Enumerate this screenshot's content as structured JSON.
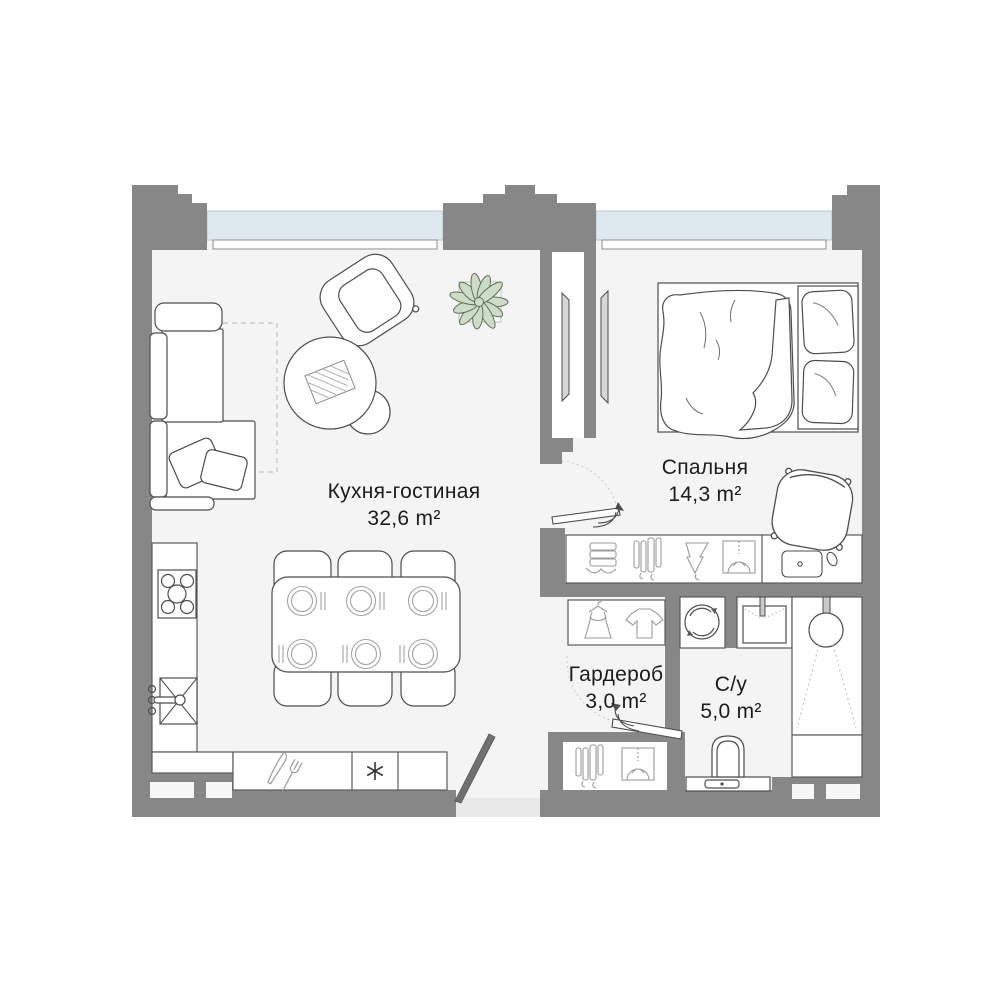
{
  "plan": {
    "rooms": [
      {
        "name": "Кухня-гостиная",
        "area": "32,6 m²"
      },
      {
        "name": "Спальня",
        "area": "14,3 m²"
      },
      {
        "name": "Гардероб",
        "area": "3,0 m²"
      },
      {
        "name": "С/у",
        "area": "5,0 m²"
      }
    ],
    "icons": {
      "freezer-asterisk-icon": "✳",
      "hob-icon": "4+1 burner circles",
      "kitchen-sink-icon": "crossed square with faucet",
      "cutlery-icon": "knife and fork",
      "washing-machine-icon": "circle with rotation arrows",
      "bathroom-sink-icon": "basin with tap",
      "shower-icon": "shower head with spray",
      "toilet-icon": "bowl with cistern button",
      "plant-icon": "leaf rosette",
      "tv-icon": "flat panel",
      "dress-icon": "dress on hanger",
      "tshirt-icon": "t-shirt",
      "hanging-clothes-icon": "garments on rail",
      "folded-clothes-icon": "stack of linen",
      "shirt-box-icon": "shirt in shelf box",
      "door-swing-icon": "dashed arc with leaf arrow"
    },
    "colors": {
      "background": "#ffffff",
      "wall": "#878787",
      "floor": "#f4f4f5",
      "window_glass": "#dde9ef",
      "threshold": "#e9e9e9",
      "plant_green": "#cddcc6",
      "outline": "#4d4d4d",
      "text": "#1c1c1c"
    }
  }
}
